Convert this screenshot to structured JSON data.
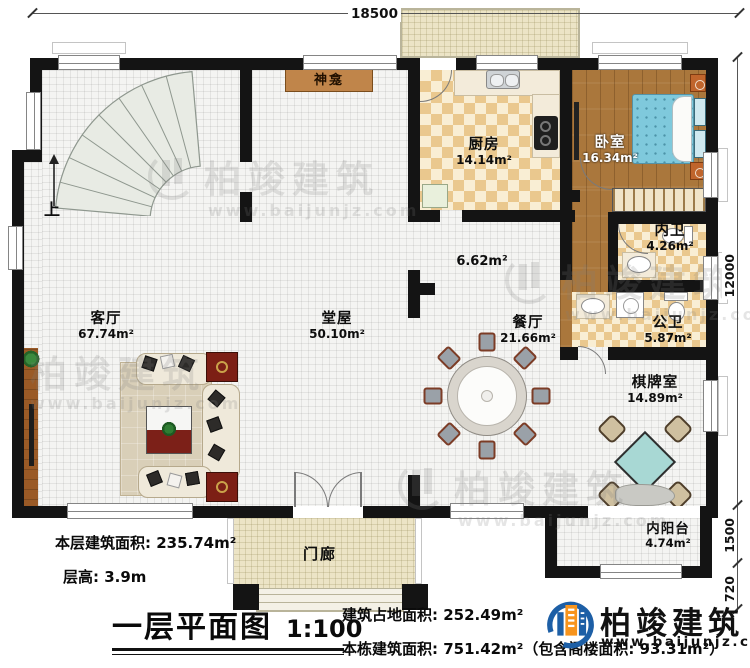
{
  "dimensions": {
    "top": "18500",
    "right_main": "12000",
    "right_balcony": "1500",
    "right_steps": "720"
  },
  "rooms": {
    "living": {
      "name": "客厅",
      "area": "67.74m²"
    },
    "hall": {
      "name": "堂屋",
      "area": "50.10m²"
    },
    "kitchen": {
      "name": "厨房",
      "area": "14.14m²"
    },
    "bedroom": {
      "name": "卧室",
      "area": "16.34m²"
    },
    "inner_bath": {
      "name": "内卫",
      "area": "4.26m²"
    },
    "public_bath": {
      "name": "公卫",
      "area": "5.87m²"
    },
    "dining": {
      "name": "餐厅",
      "area": "21.66m²"
    },
    "chess": {
      "name": "棋牌室",
      "area": "14.89m²"
    },
    "balcony": {
      "name": "内阳台",
      "area": "4.74m²"
    },
    "corridor": {
      "area": "6.62m²"
    },
    "porch": {
      "name": "门廊"
    },
    "shrine": {
      "name": "神龛"
    },
    "stairs": {
      "up": "上"
    }
  },
  "footer": {
    "floor_area_label": "本层建筑面积:",
    "floor_area_value": "235.74m²",
    "floor_height_label": "层高:",
    "floor_height_value": "3.9m",
    "plan_title": "一层平面图",
    "plan_scale": "1:100",
    "land_area_label": "建筑占地面积:",
    "land_area_value": "252.49m²",
    "total_area_label": "本栋建筑面积:",
    "total_area_value": "751.42m²",
    "total_area_note": "（包含阁楼面积: 93.31m²）"
  },
  "brand": {
    "name": "柏竣建筑",
    "url": "www.baijunjz.com"
  },
  "watermark": {
    "name": "柏竣建筑",
    "url": "www.baijunjz.com"
  }
}
